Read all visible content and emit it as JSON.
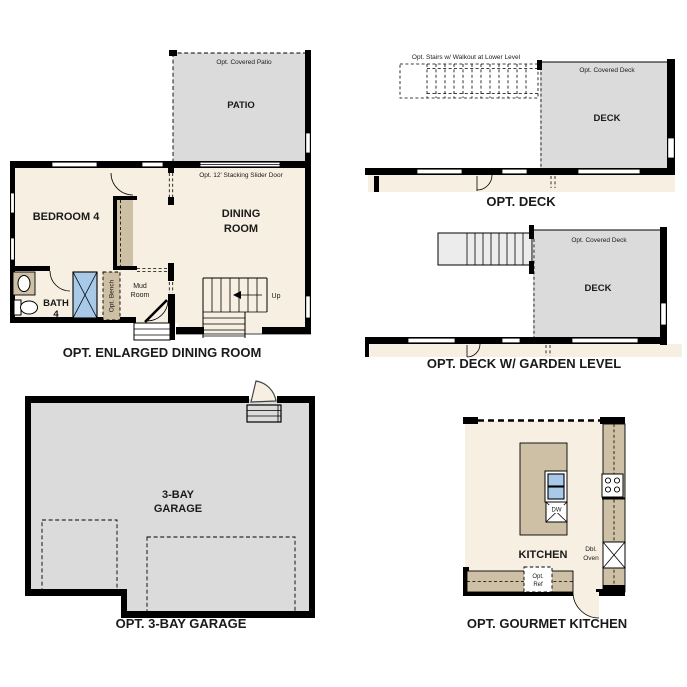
{
  "colors": {
    "floor": "#f7efe1",
    "surface": "#dbdbdb",
    "counter": "#cec0a5",
    "blue": "#a9c9e9",
    "stair": "#ececec",
    "wall": "#000000"
  },
  "plans": {
    "dining": {
      "caption": "OPT. ENLARGED DINING ROOM",
      "patio": "PATIO",
      "covered_patio": "Opt. Covered Patio",
      "slider": "Opt. 12' Stacking Slider Door",
      "bedroom": "BEDROOM 4",
      "dining1": "DINING",
      "dining2": "ROOM",
      "bath1": "BATH",
      "bath2": "4",
      "bench": "Opt. Bench",
      "mud1": "Mud",
      "mud2": "Room",
      "up": "Up"
    },
    "deck": {
      "caption": "OPT. DECK",
      "deck": "DECK",
      "covered_deck": "Opt. Covered Deck",
      "stairs_note": "Opt. Stairs w/ Walkout at Lower Level"
    },
    "deck_garden": {
      "caption": "OPT. DECK W/ GARDEN LEVEL",
      "deck": "DECK",
      "covered_deck": "Opt. Covered Deck"
    },
    "garage": {
      "caption": "OPT. 3-BAY GARAGE",
      "label1": "3-BAY",
      "label2": "GARAGE"
    },
    "kitchen": {
      "caption": "OPT. GOURMET KITCHEN",
      "label": "KITCHEN",
      "dw": "DW",
      "dbl1": "Dbl.",
      "dbl2": "Oven",
      "ref1": "Opt.",
      "ref2": "Ref"
    }
  }
}
